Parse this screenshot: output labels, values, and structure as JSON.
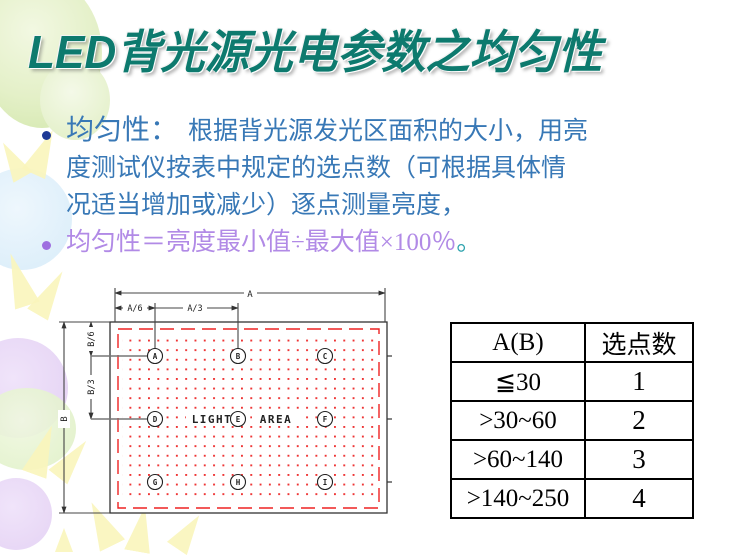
{
  "title": "LED背光源光电参数之均匀性",
  "bullet1": {
    "lead": "均匀性：",
    "line1_rest": "根据背光源发光区面积的大小，用亮",
    "line2": "度测试仪按表中规定的选点数（可根据具体情",
    "line3": "况适当增加或减少）逐点测量亮度，"
  },
  "bullet2": {
    "text": "均匀性＝亮度最小值÷最大值×100％",
    "period": "。"
  },
  "diagram": {
    "dims": {
      "a": "A",
      "a6": "A/6",
      "a3": "A/3",
      "b": "B",
      "b6": "B/6",
      "b3": "B/3"
    },
    "light": "LIGHT",
    "area": "AREA",
    "points": [
      "A",
      "B",
      "C",
      "D",
      "E",
      "F",
      "G",
      "H",
      "I"
    ]
  },
  "table": {
    "headers": [
      "A(B)",
      "选点数"
    ],
    "rows": [
      {
        "range": "≦30",
        "count": "1"
      },
      {
        "range": ">30~60",
        "count": "2"
      },
      {
        "range": ">60~140",
        "count": "3"
      },
      {
        "range": ">140~250",
        "count": "4"
      }
    ]
  },
  "colors": {
    "title_teal": "#0d7a6e",
    "body_blue": "#3878b6",
    "formula_violet": "#b18ae6",
    "period_teal": "#2ea3ae",
    "dashed_red": "#ee2222",
    "bullet1_dot": "#1e3a96",
    "bullet2_dot": "#9e6fe0"
  }
}
